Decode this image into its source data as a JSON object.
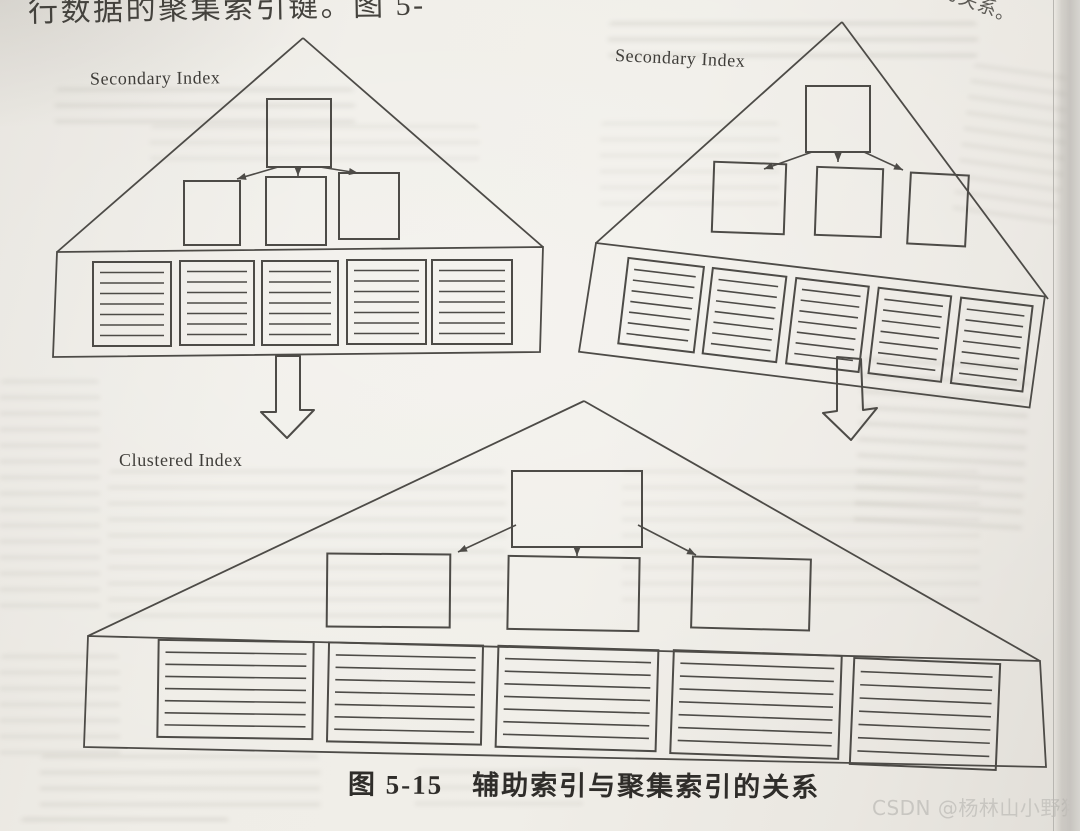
{
  "page": {
    "fragments": {
      "top_left": "行数据的聚集索引键。图 5-",
      "top_right": "索引的关系。"
    },
    "caption": "图 5-15　辅助索引与聚集索引的关系",
    "watermark": "CSDN @杨林山小野猪"
  },
  "figure": {
    "secondary_index_left": {
      "label": "Secondary Index",
      "root_pages": 1,
      "branch_pages": 3,
      "leaf_pages": 5,
      "leaf_row_lines": 7,
      "points_to": "clustered_index"
    },
    "secondary_index_right": {
      "label": "Secondary Index",
      "root_pages": 1,
      "branch_pages": 3,
      "leaf_pages": 5,
      "leaf_row_lines": 7,
      "points_to": "clustered_index"
    },
    "clustered_index": {
      "label": "Clustered Index",
      "root_pages": 1,
      "branch_pages": 3,
      "leaf_pages": 5,
      "leaf_row_lines": 7
    }
  },
  "colors": {
    "paper": "#eeece6",
    "line": "#4d4b47",
    "text": "#3b3936",
    "watermark": "#c8c6c1"
  }
}
